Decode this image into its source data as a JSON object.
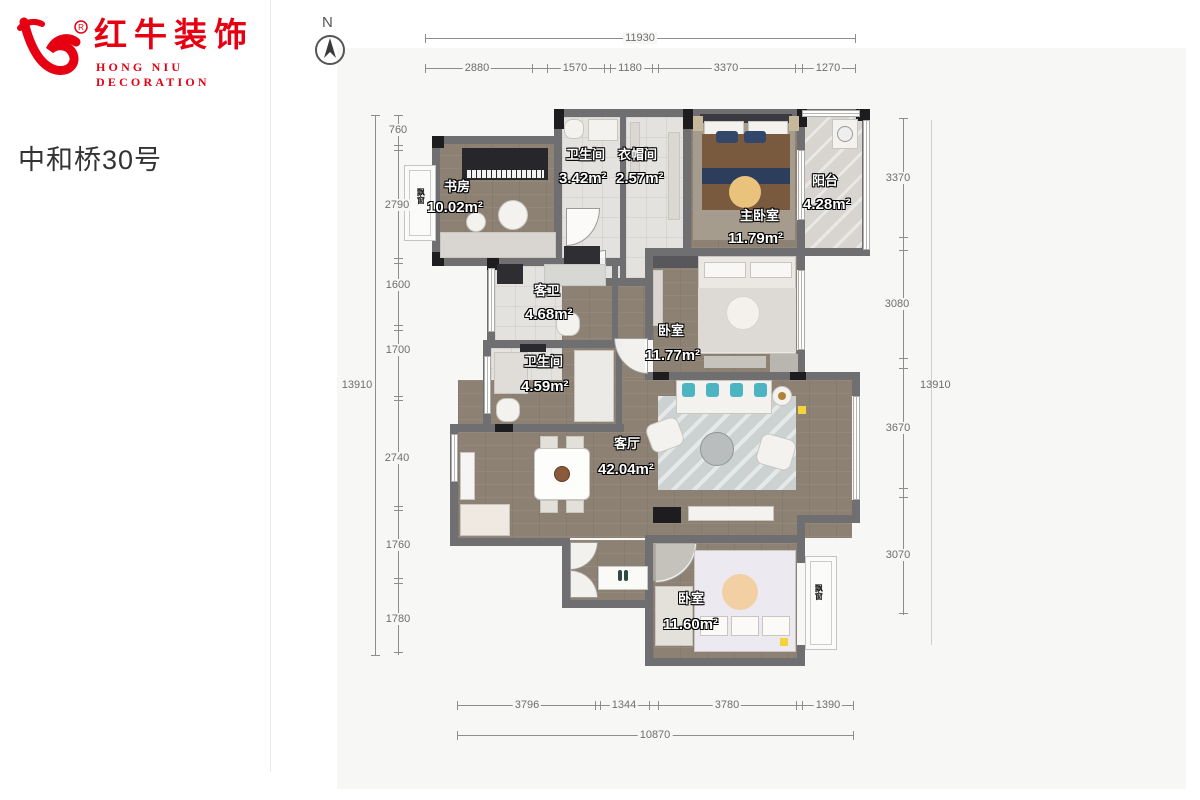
{
  "brand": {
    "name_cn": "红牛装饰",
    "name_en": "HONG NIU DECORATION",
    "registered_mark": "®",
    "color": "#e60012"
  },
  "project": {
    "title": "中和桥30号"
  },
  "compass": {
    "label": "N"
  },
  "rooms": {
    "study": {
      "name": "书房",
      "area": "10.02m²"
    },
    "bath_top": {
      "name": "卫生间",
      "area": "3.42m²"
    },
    "cloak": {
      "name": "衣帽间",
      "area": "2.57m²"
    },
    "master": {
      "name": "主卧室",
      "area": "11.79m²"
    },
    "balcony": {
      "name": "阳台",
      "area": "4.28m²"
    },
    "guest_bath": {
      "name": "客卫",
      "area": "4.68m²"
    },
    "bedroom2": {
      "name": "卧室",
      "area": "11.77m²"
    },
    "bath_mid": {
      "name": "卫生间",
      "area": "4.59m²"
    },
    "living": {
      "name": "客厅",
      "area": "42.04m²"
    },
    "bedroom3": {
      "name": "卧室",
      "area": "11.60m²"
    }
  },
  "labels": {
    "bay_window": "飘窗"
  },
  "dimensions": {
    "top": {
      "total": "11930",
      "segments": [
        "2880",
        "1570",
        "1180",
        "3370",
        "1270"
      ]
    },
    "left": {
      "total": "13910",
      "segments": [
        "760",
        "2790",
        "1600",
        "1700",
        "2740",
        "1760",
        "1780"
      ]
    },
    "right": {
      "total": "13910",
      "segments": [
        "3370",
        "3080",
        "3670",
        "3070"
      ]
    },
    "bottom": {
      "total": "10870",
      "segments": [
        "3796",
        "1344",
        "3780",
        "1390"
      ]
    }
  },
  "palette": {
    "wall": "#6f6f72",
    "wood_floor": "#8c8173",
    "tile_floor": "#e4e2de",
    "accent_teal": "#4db4c2",
    "accent_yellow": "#f6d33c"
  }
}
